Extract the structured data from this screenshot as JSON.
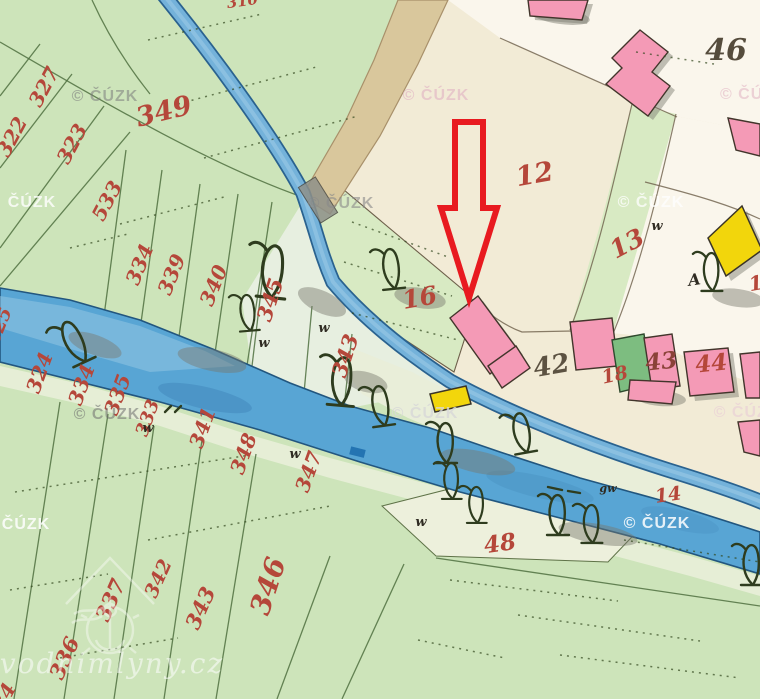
{
  "map": {
    "type": "historical-cadastral-map",
    "colors": {
      "field-green": "#cde4ba",
      "field-green2": "#d8eac3",
      "meadow-pale": "#e7efe0",
      "cream": "#f2ebd6",
      "village-white": "#faf6ec",
      "road-tan": "#d9c79c",
      "river-blue": "#58a5d4",
      "race-blue": "#74b2da",
      "water-edge": "#22567f",
      "building-pink": "#f49ab6",
      "building-yellow": "#f2d60c",
      "building-green": "#7dbd80",
      "number-red": "#b5473a",
      "arrow-red": "#e81a20",
      "line-green": "#4f7040",
      "ink-dark": "#3a3428"
    },
    "parcel_labels": [
      {
        "t": "322",
        "x": 18,
        "y": 140,
        "r": -62,
        "s": 20
      },
      {
        "t": "327",
        "x": 50,
        "y": 90,
        "r": -62,
        "s": 20
      },
      {
        "t": "323",
        "x": 78,
        "y": 147,
        "r": -62,
        "s": 20
      },
      {
        "t": "533",
        "x": 113,
        "y": 204,
        "r": -62,
        "s": 20
      },
      {
        "t": "349",
        "x": 166,
        "y": 120,
        "r": -14,
        "s": 27
      },
      {
        "t": "334",
        "x": 146,
        "y": 267,
        "r": -68,
        "s": 20
      },
      {
        "t": "339",
        "x": 178,
        "y": 277,
        "r": -68,
        "s": 20
      },
      {
        "t": "340",
        "x": 220,
        "y": 288,
        "r": -68,
        "s": 20
      },
      {
        "t": "325",
        "x": 5,
        "y": 328,
        "r": -68,
        "s": 18
      },
      {
        "t": "310",
        "x": 243,
        "y": 6,
        "r": -8,
        "s": 15
      },
      {
        "t": "324",
        "x": 46,
        "y": 375,
        "r": -70,
        "s": 20
      },
      {
        "t": "334",
        "x": 88,
        "y": 387,
        "r": -70,
        "s": 20
      },
      {
        "t": "335",
        "x": 124,
        "y": 397,
        "r": -70,
        "s": 20
      },
      {
        "t": "333",
        "x": 153,
        "y": 420,
        "r": -70,
        "s": 18
      },
      {
        "t": "341",
        "x": 209,
        "y": 430,
        "r": -70,
        "s": 20
      },
      {
        "t": "348",
        "x": 250,
        "y": 456,
        "r": -70,
        "s": 20
      },
      {
        "t": "347",
        "x": 315,
        "y": 474,
        "r": -70,
        "s": 20
      },
      {
        "t": "345",
        "x": 277,
        "y": 302,
        "r": -72,
        "s": 21
      },
      {
        "t": "343",
        "x": 352,
        "y": 358,
        "r": -72,
        "s": 21
      },
      {
        "t": "346",
        "x": 277,
        "y": 589,
        "r": -72,
        "s": 28
      },
      {
        "t": "336",
        "x": 71,
        "y": 661,
        "r": -66,
        "s": 21
      },
      {
        "t": "337",
        "x": 117,
        "y": 603,
        "r": -66,
        "s": 21
      },
      {
        "t": "342",
        "x": 164,
        "y": 581,
        "r": -66,
        "s": 19
      },
      {
        "t": "343",
        "x": 207,
        "y": 611,
        "r": -66,
        "s": 21
      },
      {
        "t": "34",
        "x": 10,
        "y": 700,
        "r": -62,
        "s": 20
      },
      {
        "t": "16",
        "x": 421,
        "y": 306,
        "r": -10,
        "s": 25
      },
      {
        "t": "12",
        "x": 536,
        "y": 183,
        "r": -10,
        "s": 27
      },
      {
        "t": "13",
        "x": 631,
        "y": 251,
        "r": -28,
        "s": 25
      },
      {
        "t": "18",
        "x": 616,
        "y": 381,
        "r": -12,
        "s": 19
      },
      {
        "t": "43",
        "x": 662,
        "y": 369,
        "r": -6,
        "s": 23,
        "c": "#8a4238"
      },
      {
        "t": "44",
        "x": 712,
        "y": 371,
        "r": -6,
        "s": 23
      },
      {
        "t": "48",
        "x": 501,
        "y": 551,
        "r": -8,
        "s": 23
      },
      {
        "t": "14",
        "x": 669,
        "y": 501,
        "r": -8,
        "s": 19
      },
      {
        "t": "42",
        "x": 553,
        "y": 374,
        "r": -10,
        "s": 26,
        "c": "#5c5242"
      },
      {
        "t": "46",
        "x": 726,
        "y": 60,
        "r": 0,
        "s": 30,
        "c": "#554c3c"
      },
      {
        "t": "A",
        "x": 695,
        "y": 285,
        "r": -8,
        "s": 16,
        "c": "#2f2b22"
      },
      {
        "t": "1",
        "x": 757,
        "y": 290,
        "r": -10,
        "s": 20
      }
    ],
    "landuse_marks": [
      {
        "t": "w",
        "x": 148,
        "y": 432
      },
      {
        "t": "w",
        "x": 264,
        "y": 347
      },
      {
        "t": "w",
        "x": 324,
        "y": 332
      },
      {
        "t": "w",
        "x": 295,
        "y": 458
      },
      {
        "t": "w",
        "x": 421,
        "y": 526
      },
      {
        "t": "w",
        "x": 657,
        "y": 230
      },
      {
        "t": "gw",
        "x": 608,
        "y": 492,
        "s": 11
      }
    ],
    "watermarks": [
      {
        "t": "© ČÚZK",
        "x": 105,
        "y": 101,
        "c": "#7d7d7d",
        "o": 0.55
      },
      {
        "t": "ČÚZK",
        "x": 32,
        "y": 207,
        "c": "#ffffff",
        "o": 0.8
      },
      {
        "t": "© ČÚZK",
        "x": 107,
        "y": 419,
        "c": "#6f6f6f",
        "o": 0.55
      },
      {
        "t": "ČÚZK",
        "x": 26,
        "y": 529,
        "c": "#ffffff",
        "o": 0.85
      },
      {
        "t": "© ČÚZK",
        "x": 436,
        "y": 100,
        "c": "#e3bac6",
        "o": 0.7
      },
      {
        "t": "© ČÚZK",
        "x": 341,
        "y": 208,
        "c": "#8a8a8a",
        "o": 0.6
      },
      {
        "t": "© ČÚZK",
        "x": 651,
        "y": 207,
        "c": "#ffffff",
        "o": 0.75
      },
      {
        "t": "© ČÚZ",
        "x": 747,
        "y": 99,
        "c": "#e3bac6",
        "o": 0.6
      },
      {
        "t": "© ČÚZK",
        "x": 425,
        "y": 418,
        "c": "#d8d8d8",
        "o": 0.8
      },
      {
        "t": "© ČÚZK",
        "x": 657,
        "y": 528,
        "c": "#ffffff",
        "o": 0.85
      },
      {
        "t": "© ČÚZK",
        "x": 747,
        "y": 417,
        "c": "#e9cdd6",
        "o": 0.6
      },
      {
        "t": "vodnimlyny.cz",
        "x": 112,
        "y": 673,
        "c": "#ffffff",
        "o": 0.55,
        "s": 28,
        "f": "serif"
      }
    ]
  }
}
